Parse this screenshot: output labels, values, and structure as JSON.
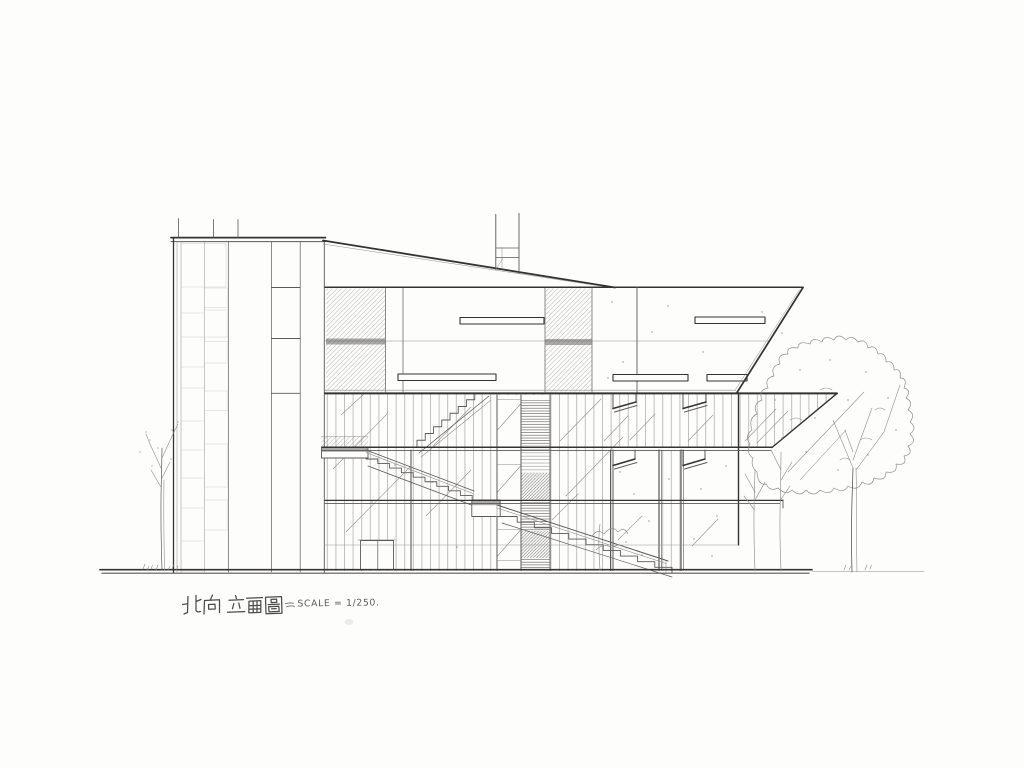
{
  "page": {
    "background": "#ffffff",
    "paper": "#fdfdfc"
  },
  "colors": {
    "pencil_faint": "#c3c1bb",
    "pencil_light": "#908e88",
    "pencil": "#5c5a55",
    "pencil_dark": "#35332f"
  },
  "title_block": {
    "title": "北向 立面圖",
    "scale_label": "SCALE = 1/250."
  },
  "drawing": {
    "type": "hand-drawn pencil architectural elevation",
    "elements": [
      "stair-tower-with-louver-panels",
      "sloped-roofline",
      "upper-floor-volume-with-ribbon-windows",
      "glass-curtain-wall",
      "sectional-stairs-three-flights",
      "roof-chimney",
      "entry-door",
      "canopy-wedge",
      "ground-line",
      "bare-tree-left",
      "large-tree-right",
      "small-trees-front"
    ]
  }
}
